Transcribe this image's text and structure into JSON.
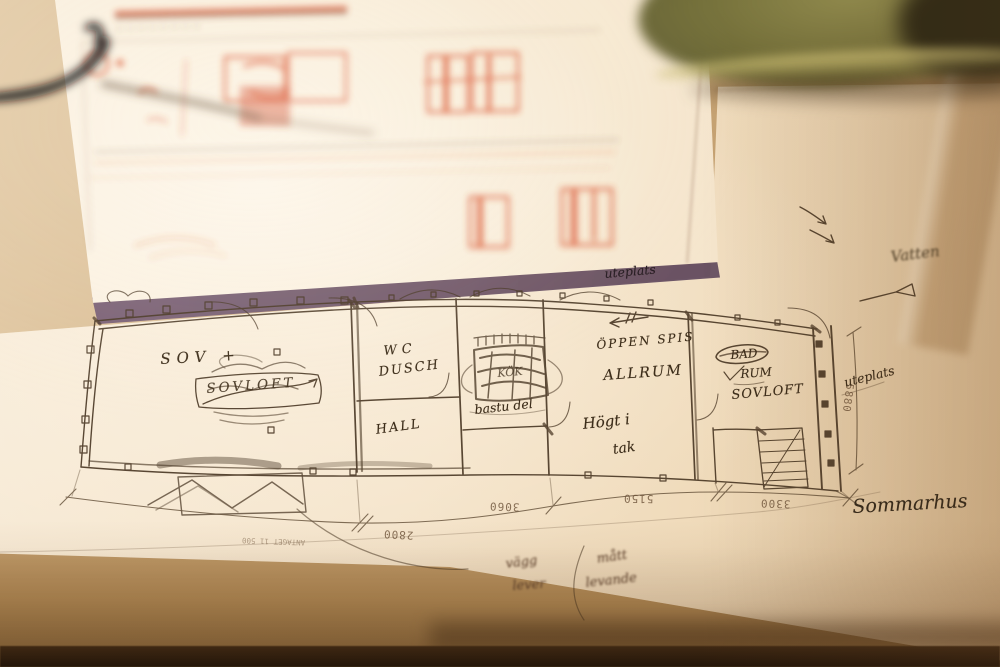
{
  "floor_plan": {
    "room_labels": {
      "sov": "SOV +",
      "sovloft_crossed": "SOVLOFT",
      "wc": "WC",
      "dusch": "DUSCH",
      "hall": "HALL",
      "kok": "KÖK",
      "bastu_del": "bastu del",
      "oppen_spis": "ÖPPEN SPIS",
      "allrum": "ALLRUM",
      "hogt_i": "Högt i",
      "tak": "tak",
      "bad": "BAD",
      "rum": "RUM",
      "sovloft_right": "SOVLOFT"
    },
    "dimensions": {
      "d2800": "2800",
      "d3060": "3060",
      "d5150": "5150",
      "d3300": "3300",
      "d5880": "5880"
    },
    "scale_note": "ANTAGET 11 500"
  },
  "annotations": {
    "uteplats_top": "uteplats",
    "uteplats_right": "uteplats",
    "vatten": "Vatten",
    "sommarhus": "Sommarhus",
    "note_vagg": "vägg",
    "note_lever": "lever",
    "note_matt": "mått",
    "note_levande": "levande"
  },
  "colors": {
    "ink": "#473522",
    "red_sketch": "#d8502c",
    "paper": "#f6e8d2",
    "table": "#c29d6c",
    "folder_edge_purple": "#6b5367",
    "basket_olive": "#716d38"
  }
}
